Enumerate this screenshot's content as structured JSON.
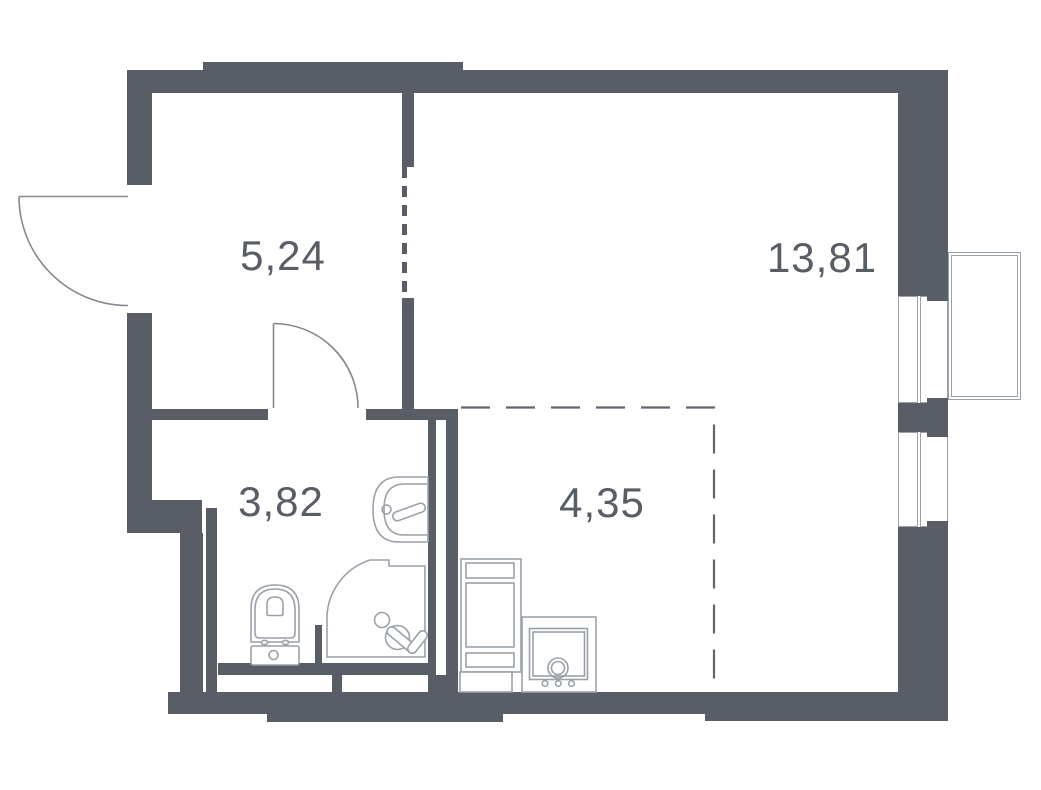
{
  "plan": {
    "type": "apartment-floor-plan",
    "rooms": [
      {
        "name": "hallway",
        "area_label": "5,24"
      },
      {
        "name": "living-room",
        "area_label": "13,81"
      },
      {
        "name": "bathroom",
        "area_label": "3,82"
      },
      {
        "name": "kitchen-zone",
        "area_label": "4,35"
      }
    ],
    "fixtures": [
      "entry-door",
      "bathroom-door",
      "toilet",
      "washbasin",
      "shower",
      "tall-cabinet",
      "stove",
      "window-upper",
      "window-lower",
      "balcony"
    ],
    "colors": {
      "wall": "#585d66",
      "fixture_line": "#9ba1a9",
      "door_line": "#84898f",
      "dash_line": "#60656e",
      "label_text": "#585d66",
      "background": "#ffffff"
    }
  }
}
